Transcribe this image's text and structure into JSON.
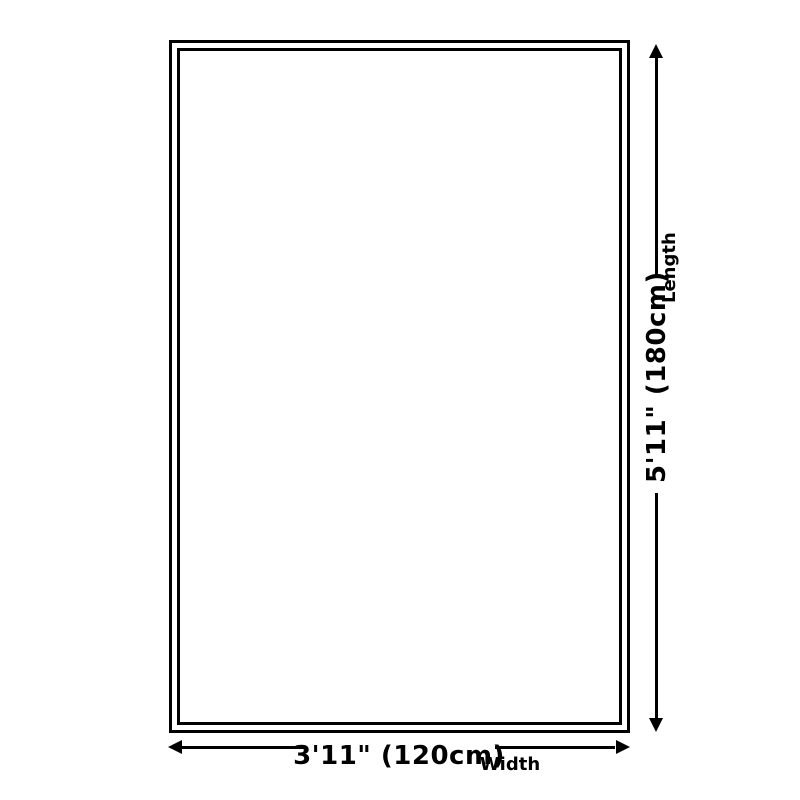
{
  "diagram": {
    "type": "product-size-diagram",
    "background_color": "#ffffff",
    "line_color": "#000000",
    "shape": {
      "kind": "rectangle-double-border"
    },
    "dimensions": {
      "length": {
        "value": "5'11\" (180cm)",
        "axis_label": "Length",
        "cm": 180,
        "feet_inches": "5'11\""
      },
      "width": {
        "value": "3'11\" (120cm)",
        "axis_label": "Width",
        "cm": 120,
        "feet_inches": "3'11\""
      }
    }
  }
}
